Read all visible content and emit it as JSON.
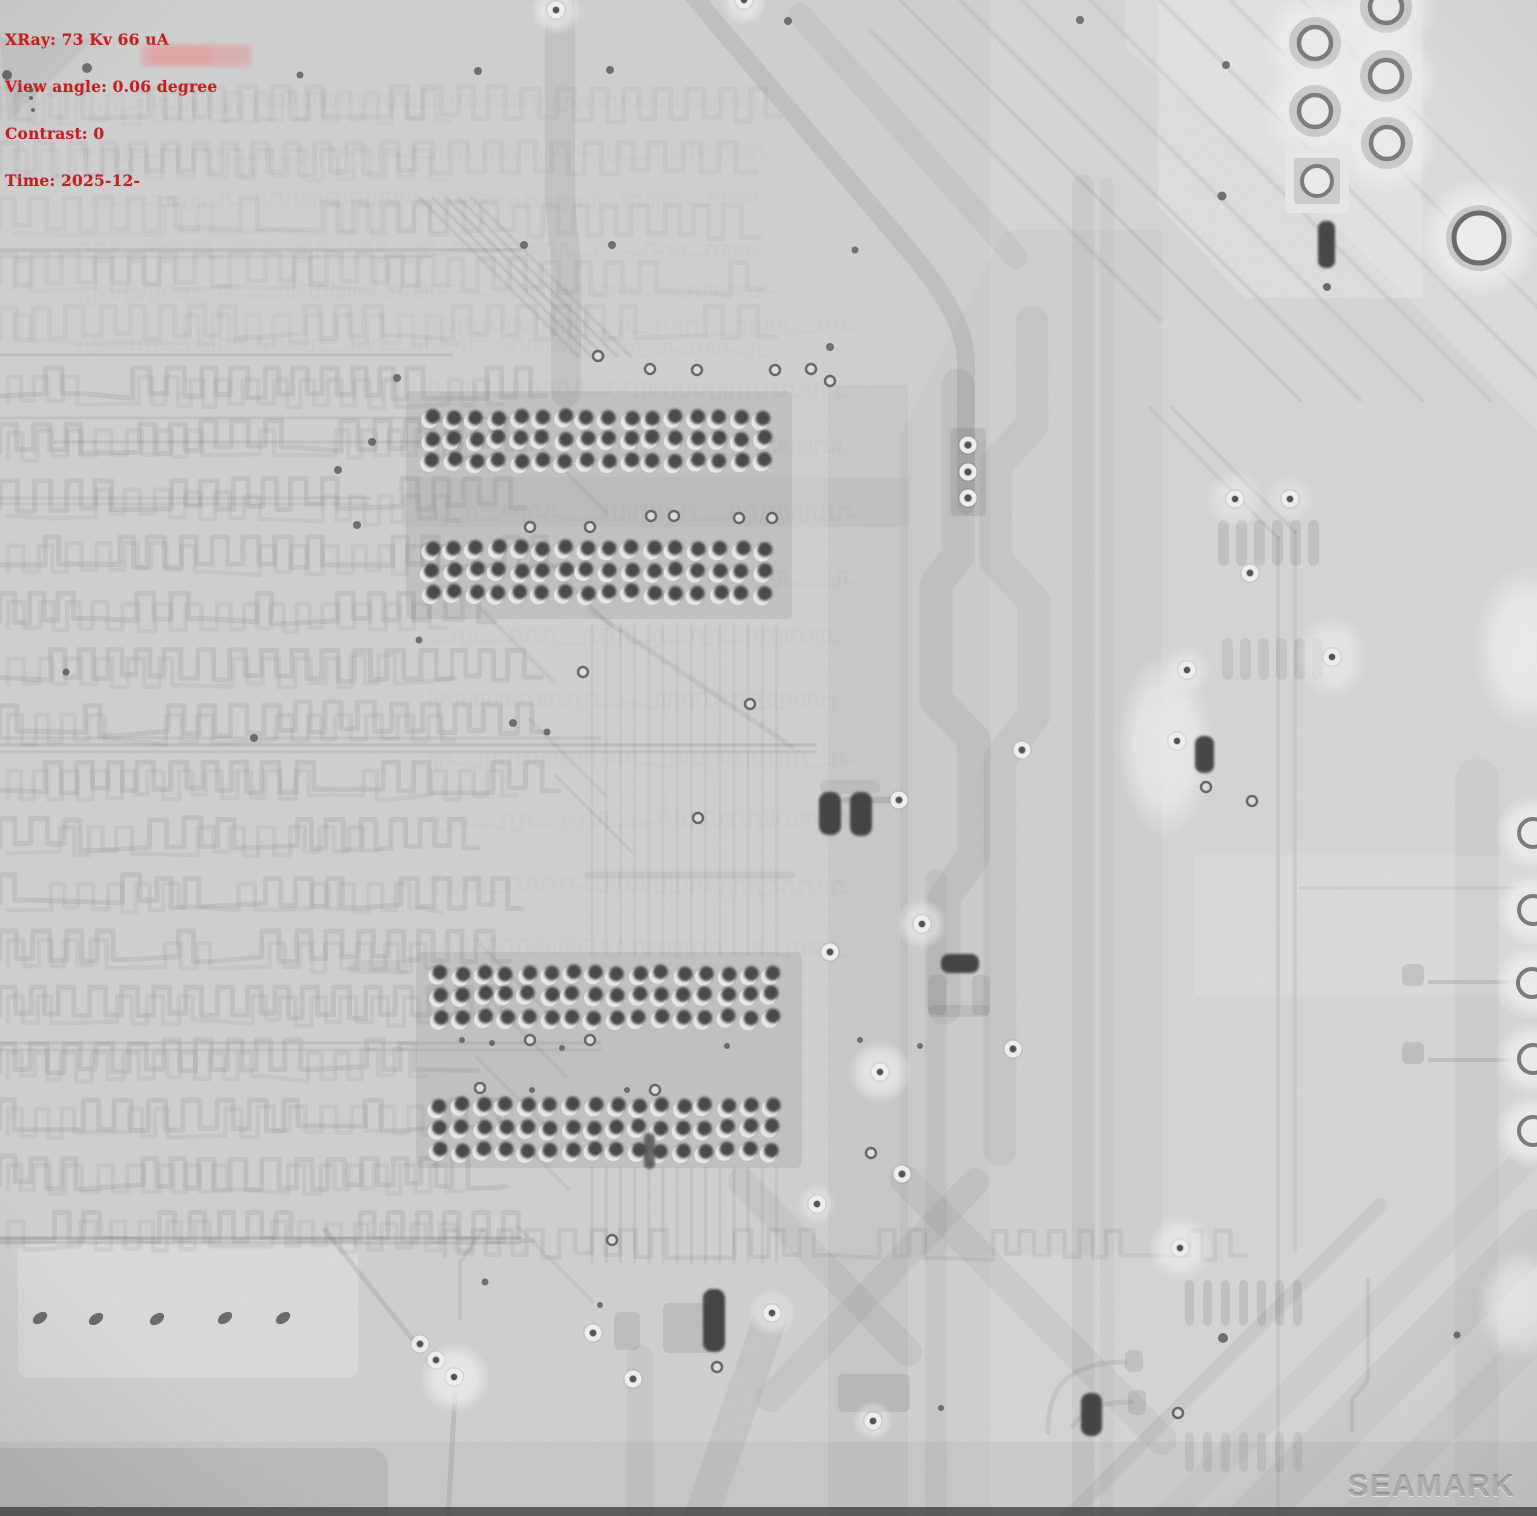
{
  "overlay": {
    "lines": [
      "XRay: 73 Kv 66 uA",
      "View angle: 0.06 degree",
      "Contrast: 0",
      "Time: 2025-12-"
    ]
  },
  "watermark": {
    "text": "SEAMARK"
  },
  "colors": {
    "overlay_text": "#c42020",
    "redaction_pink_outer": "rgba(226,138,138,0.45)",
    "redaction_pink_inner": "rgba(232,156,156,0.55)",
    "board_base": "#d8d8d8",
    "pad_dark": "#1c1c1c",
    "trace_gray": "#9a9a9a"
  }
}
